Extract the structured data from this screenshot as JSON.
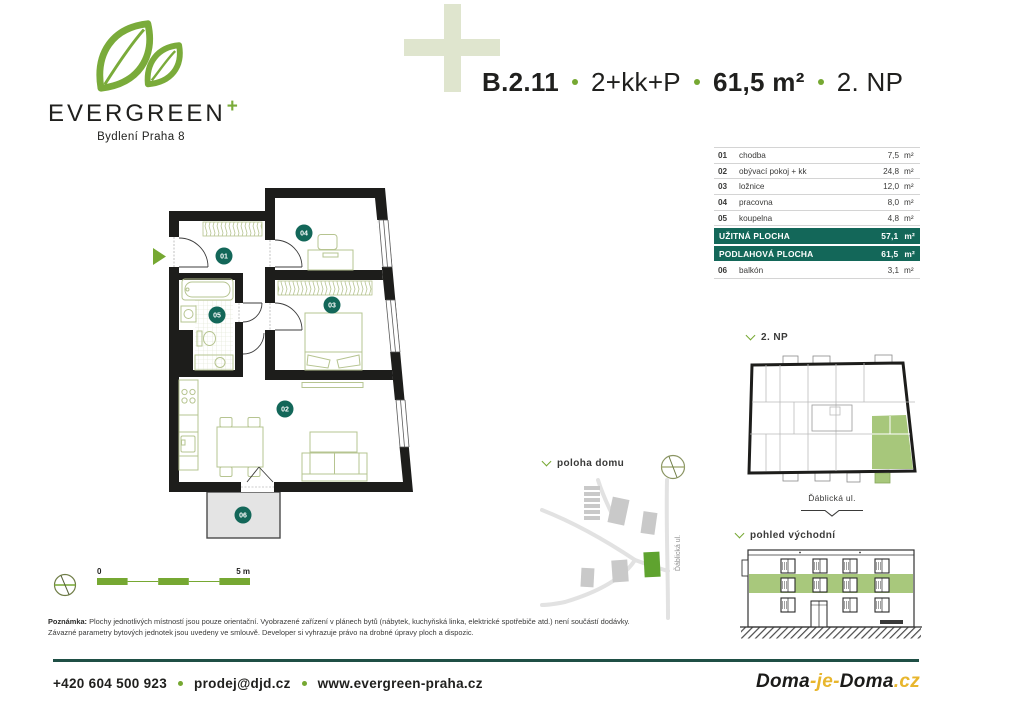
{
  "brand": {
    "name": "EVERGREEN",
    "plus": "+",
    "tagline": "Bydlení Praha 8"
  },
  "header": {
    "unit_id": "B.2.11",
    "layout": "2+kk+P",
    "area": "61,5 m²",
    "floor": "2. NP"
  },
  "room_table": {
    "unit_suffix": "m²",
    "rows": [
      {
        "num": "01",
        "name": "chodba",
        "value": "7,5"
      },
      {
        "num": "02",
        "name": "obývací pokoj + kk",
        "value": "24,8"
      },
      {
        "num": "03",
        "name": "ložnice",
        "value": "12,0"
      },
      {
        "num": "04",
        "name": "pracovna",
        "value": "8,0"
      },
      {
        "num": "05",
        "name": "koupelna",
        "value": "4,8"
      }
    ],
    "banner1": {
      "label": "UŽITNÁ PLOCHA",
      "value": "57,1"
    },
    "banner2": {
      "label": "PODLAHOVÁ PLOCHA",
      "value": "61,5"
    },
    "row06": {
      "num": "06",
      "name": "balkón",
      "value": "3,1"
    }
  },
  "floor_plan": {
    "labels": {
      "l01": "01",
      "l02": "02",
      "l03": "03",
      "l04": "04",
      "l05": "05",
      "l06": "06"
    }
  },
  "scale_bar": {
    "zero": "0",
    "five": "5 m"
  },
  "overview": {
    "title": "2. NP",
    "street": "Ďáblická ul."
  },
  "site": {
    "title": "poloha domu",
    "street": "Ďáblická ul."
  },
  "elevation": {
    "title": "pohled východní"
  },
  "note": {
    "label": "Poznámka:",
    "line1": "Plochy jednotlivých místností jsou pouze orientační. Vyobrazené zařízení v plánech bytů (nábytek, kuchyňská linka, elektrické spotřebiče atd.) není součástí dodávky.",
    "line2": "Závazné parametry bytových jednotek jsou uvedeny ve smlouvě. Developer si vyhrazuje právo na drobné úpravy ploch a dispozic."
  },
  "footer": {
    "phone": "+420 604 500 923",
    "email": "prodej@djd.cz",
    "web": "www.evergreen-praha.cz"
  },
  "partner": {
    "p1": "Doma",
    "h1": "-",
    "p2": "je",
    "h2": "-",
    "p3": "Doma",
    "dot": ".",
    "tld": "cz"
  },
  "colors": {
    "accent_green": "#76a832",
    "leaf_green": "#7aab3a",
    "teal": "#136759",
    "pale_plus": "#dfe5ce",
    "highlight_green": "#a7c77b",
    "furniture_olive": "#b6c490"
  }
}
